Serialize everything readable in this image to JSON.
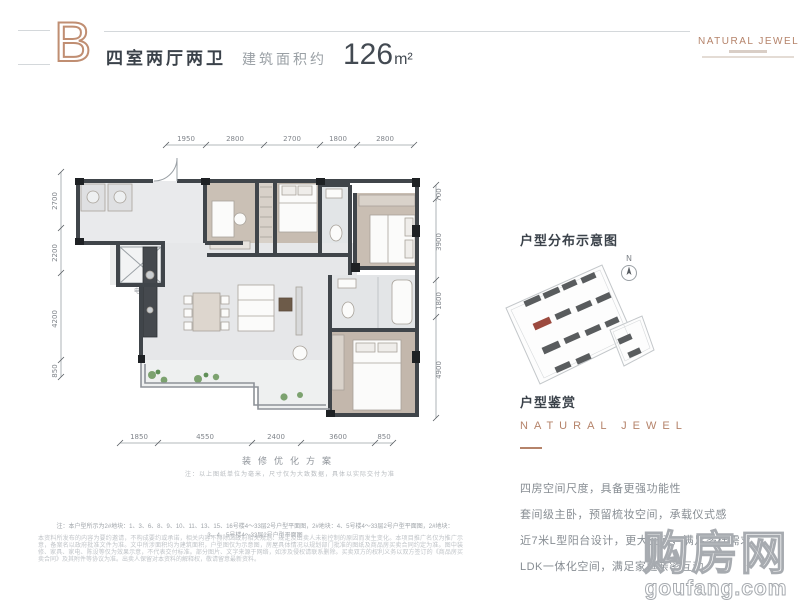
{
  "header": {
    "unit_letter": "B",
    "unit_type": "四室两厅两卫",
    "area_label": "建筑面积约",
    "area_value": "126",
    "area_unit": "m²",
    "brand": "NATURAL JEWEL"
  },
  "plan": {
    "dims_top": [
      "1950",
      "2800",
      "2700",
      "1800",
      "2800"
    ],
    "dims_left": [
      "2700",
      "2200",
      "4200",
      "850"
    ],
    "dims_right": [
      "700",
      "3900",
      "1800",
      "4900"
    ],
    "dims_bottom": [
      "1850",
      "4550",
      "2400",
      "3600",
      "850"
    ],
    "labels": {
      "elevator": "电梯"
    },
    "caption": "装修优化方案",
    "caption_note": "注：以上图纸单位为毫米，尺寸仅为大致数据，具体以实际交付为准"
  },
  "sidebar": {
    "distribution_title": "户型分布示意图",
    "north_label": "N",
    "appreciation_title": "户型鉴赏",
    "brand_line": "NATURAL JEWEL",
    "features": [
      "四房空间尺度，具备更强功能性",
      "套间级主卧，预留梳妆空间，承载仪式感",
      "近7米L型阳台设计，更大空间，满足多样需求",
      "LDK一体化空间，满足家庭亲密互动"
    ]
  },
  "footer": {
    "note": "注：本户型所示为2#地块：1、3、6、8、9、10、11、13、15、16号楼4～33层2号户型平面图，2#地块：4、5号楼4～33层2号户型平面图，2#地块：3、4、5号楼4～33层2号户型平面图",
    "disclaimer": "本资料所发布的内容为要约邀请，不构成要约或承诺，相关内容不排除因政府相关规划、规定及出卖人未能控制的原因而发生变化。本项目推广名仅为推广示意，备案名以政府批准文件为准。文中所涉面积均为建筑面积，户型图仅为示意图，房屋具体情况以规划部门批准的图纸及商品房买卖合同约定为准。图中装修、家具、家电、陈设等仅为效果示意，不代表交付标准。部分图片、文字来源于网络，如涉及侵权请联系删除。买卖双方的权利义务以双方签订的《商品房买卖合同》及其附件等协议为准。出卖人保留对本资料的解释权，敬请留意最新资料。"
  },
  "watermark": {
    "cn": "购房网",
    "en": "goufang.com"
  },
  "colors": {
    "accent": "#b5836a",
    "dark_text": "#3b424a",
    "gray_text": "#878d93",
    "wall": "#40454a",
    "wood_floor": "#c9beb3",
    "tile_floor": "#e7e8ea",
    "plant": "#7ca26f",
    "site_block": "#595c5e",
    "site_highlight": "#9c4a3f"
  }
}
